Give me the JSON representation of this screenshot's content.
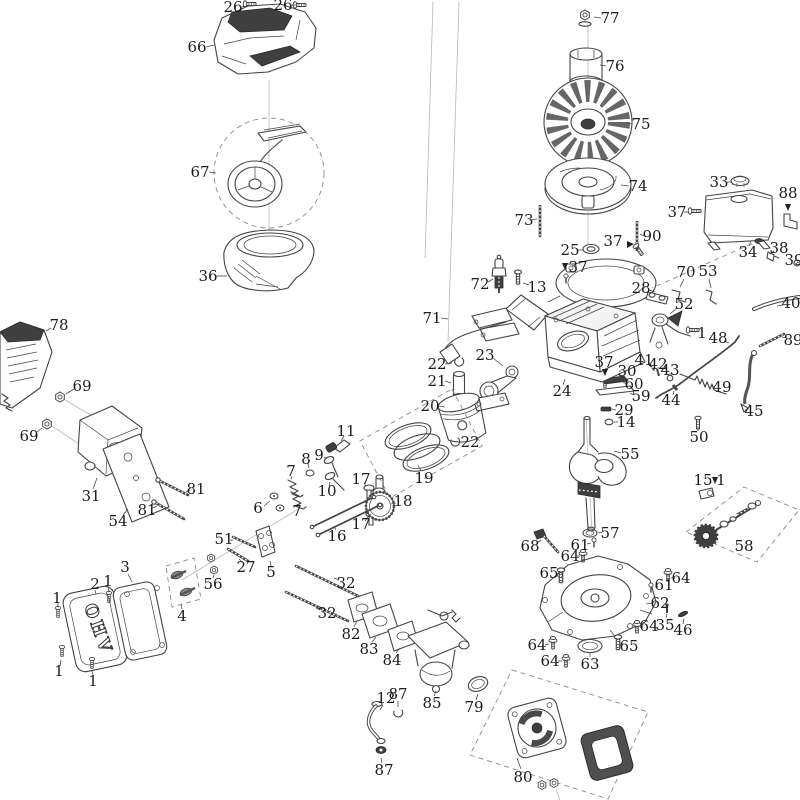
{
  "diagram": {
    "title": "engine-exploded-parts-diagram",
    "cover_text": "OHV",
    "colors": {
      "background": "#ffffff",
      "line": "#444444",
      "label": "#1c1c1c",
      "dark_fill": "#3f3f3f",
      "dash": "#8a8a8a"
    },
    "labels": [
      {
        "t": "26",
        "x": 233,
        "y": 7,
        "l": [
          241,
          7,
          247,
          6
        ]
      },
      {
        "t": "26",
        "x": 283,
        "y": 5,
        "l": [
          291,
          5,
          297,
          5
        ]
      },
      {
        "t": "66",
        "x": 197,
        "y": 47,
        "l": [
          206,
          47,
          214,
          45
        ]
      },
      {
        "t": "67",
        "x": 200,
        "y": 172,
        "l": [
          209,
          172,
          216,
          173
        ]
      },
      {
        "t": "36",
        "x": 208,
        "y": 276,
        "l": [
          216,
          276,
          227,
          276
        ]
      },
      {
        "t": "77",
        "x": 610,
        "y": 18,
        "l": [
          601,
          18,
          594,
          17
        ]
      },
      {
        "t": "76",
        "x": 615,
        "y": 66,
        "l": [
          606,
          66,
          600,
          65
        ]
      },
      {
        "t": "75",
        "x": 641,
        "y": 124,
        "l": [
          632,
          124,
          626,
          123
        ]
      },
      {
        "t": "74",
        "x": 638,
        "y": 186,
        "l": [
          629,
          186,
          621,
          185
        ]
      },
      {
        "t": "73",
        "x": 524,
        "y": 220,
        "l": [
          531,
          220,
          537,
          219
        ]
      },
      {
        "t": "25",
        "x": 570,
        "y": 250,
        "l": [
          578,
          250,
          584,
          250
        ]
      },
      {
        "t": "37",
        "x": 613,
        "y": 241
      },
      {
        "t": "37",
        "x": 578,
        "y": 267
      },
      {
        "t": "90",
        "x": 652,
        "y": 236,
        "l": [
          644,
          236,
          640,
          234
        ]
      },
      {
        "t": "33",
        "x": 719,
        "y": 182,
        "l": [
          727,
          182,
          732,
          182
        ]
      },
      {
        "t": "88",
        "x": 788,
        "y": 193
      },
      {
        "t": "37",
        "x": 677,
        "y": 212,
        "l": [
          684,
          212,
          688,
          212
        ]
      },
      {
        "t": "34",
        "x": 748,
        "y": 252,
        "l": [
          749,
          246,
          751,
          241
        ]
      },
      {
        "t": "38",
        "x": 779,
        "y": 248,
        "l": [
          774,
          251,
          770,
          254
        ]
      },
      {
        "t": "39",
        "x": 794,
        "y": 260,
        "l": [
          797,
          262,
          799,
          263
        ]
      },
      {
        "t": "40",
        "x": 791,
        "y": 303,
        "l": [
          783,
          305,
          777,
          306
        ]
      },
      {
        "t": "89",
        "x": 793,
        "y": 340,
        "l": [
          786,
          338,
          782,
          337
        ]
      },
      {
        "t": "28",
        "x": 641,
        "y": 288,
        "l": [
          649,
          290,
          655,
          292
        ]
      },
      {
        "t": "70",
        "x": 686,
        "y": 272,
        "l": [
          684,
          279,
          680,
          287
        ]
      },
      {
        "t": "53",
        "x": 708,
        "y": 271,
        "l": [
          709,
          279,
          711,
          288
        ]
      },
      {
        "t": "52",
        "x": 684,
        "y": 304,
        "l": [
          677,
          308,
          670,
          314
        ]
      },
      {
        "t": "1",
        "x": 702,
        "y": 333,
        "l": [
          696,
          332,
          692,
          331
        ]
      },
      {
        "t": "48",
        "x": 718,
        "y": 338,
        "l": [
          724,
          341,
          729,
          343
        ]
      },
      {
        "t": "41",
        "x": 644,
        "y": 360,
        "l": [
          648,
          363,
          650,
          366
        ]
      },
      {
        "t": "42",
        "x": 658,
        "y": 364,
        "l": [
          658,
          367,
          658,
          370
        ]
      },
      {
        "t": "43",
        "x": 670,
        "y": 370,
        "l": [
          670,
          373,
          670,
          376
        ]
      },
      {
        "t": "44",
        "x": 671,
        "y": 400,
        "l": [
          673,
          395,
          674,
          391
        ]
      },
      {
        "t": "49",
        "x": 722,
        "y": 387,
        "l": [
          715,
          387,
          712,
          387
        ]
      },
      {
        "t": "45",
        "x": 754,
        "y": 411,
        "l": [
          751,
          407,
          749,
          404
        ]
      },
      {
        "t": "50",
        "x": 699,
        "y": 437,
        "l": [
          698,
          431,
          698,
          428
        ]
      },
      {
        "t": "30",
        "x": 627,
        "y": 371,
        "l": [
          621,
          371,
          619,
          371
        ]
      },
      {
        "t": "60",
        "x": 634,
        "y": 384,
        "l": [
          627,
          384,
          623,
          382
        ]
      },
      {
        "t": "59",
        "x": 641,
        "y": 396,
        "l": [
          634,
          395,
          630,
          393
        ]
      },
      {
        "t": "29",
        "x": 624,
        "y": 410,
        "l": [
          616,
          410,
          612,
          409
        ]
      },
      {
        "t": "14",
        "x": 626,
        "y": 422,
        "l": [
          618,
          422,
          614,
          422
        ]
      },
      {
        "t": "37",
        "x": 604,
        "y": 362
      },
      {
        "t": "72",
        "x": 480,
        "y": 284,
        "l": [
          488,
          282,
          493,
          279
        ]
      },
      {
        "t": "13",
        "x": 537,
        "y": 287,
        "l": [
          529,
          285,
          523,
          283
        ]
      },
      {
        "t": "71",
        "x": 432,
        "y": 318,
        "l": [
          441,
          318,
          448,
          319
        ]
      },
      {
        "t": "24",
        "x": 562,
        "y": 391,
        "l": [
          563,
          385,
          565,
          379
        ]
      },
      {
        "t": "23",
        "x": 485,
        "y": 355,
        "l": [
          493,
          358,
          503,
          366
        ]
      },
      {
        "t": "22",
        "x": 437,
        "y": 364,
        "l": [
          445,
          364,
          452,
          363
        ]
      },
      {
        "t": "21",
        "x": 437,
        "y": 381,
        "l": [
          445,
          381,
          451,
          383
        ]
      },
      {
        "t": "20",
        "x": 430,
        "y": 406,
        "l": [
          438,
          406,
          445,
          407
        ]
      },
      {
        "t": "19",
        "x": 424,
        "y": 478,
        "l": [
          421,
          471,
          418,
          465
        ]
      },
      {
        "t": "22",
        "x": 470,
        "y": 442,
        "l": [
          462,
          442,
          458,
          442
        ]
      },
      {
        "t": "11",
        "x": 346,
        "y": 431,
        "l": [
          344,
          436,
          341,
          441
        ]
      },
      {
        "t": "9",
        "x": 319,
        "y": 455,
        "l": [
          324,
          457,
          327,
          459
        ]
      },
      {
        "t": "8",
        "x": 306,
        "y": 459,
        "l": [
          308,
          464,
          309,
          468
        ]
      },
      {
        "t": "7",
        "x": 291,
        "y": 471,
        "l": [
          292,
          476,
          291,
          479
        ]
      },
      {
        "t": "7",
        "x": 297,
        "y": 511,
        "l": [
          298,
          506,
          300,
          503
        ]
      },
      {
        "t": "6",
        "x": 258,
        "y": 508,
        "l": [
          264,
          506,
          270,
          501
        ]
      },
      {
        "t": "10",
        "x": 327,
        "y": 491,
        "l": [
          329,
          486,
          330,
          482
        ]
      },
      {
        "t": "17",
        "x": 361,
        "y": 479,
        "l": [
          364,
          483,
          366,
          486
        ]
      },
      {
        "t": "17",
        "x": 361,
        "y": 524,
        "l": [
          365,
          521,
          368,
          517
        ]
      },
      {
        "t": "18",
        "x": 403,
        "y": 501,
        "l": [
          396,
          503,
          391,
          504
        ]
      },
      {
        "t": "16",
        "x": 337,
        "y": 536,
        "l": [
          336,
          530,
          334,
          526
        ]
      },
      {
        "t": "78",
        "x": 59,
        "y": 325,
        "l": [
          51,
          328,
          46,
          331
        ]
      },
      {
        "t": "69",
        "x": 82,
        "y": 386,
        "l": [
          74,
          389,
          66,
          394
        ]
      },
      {
        "t": "69",
        "x": 29,
        "y": 436,
        "l": [
          37,
          432,
          42,
          428
        ]
      },
      {
        "t": "31",
        "x": 91,
        "y": 496,
        "l": [
          93,
          489,
          97,
          478
        ]
      },
      {
        "t": "54",
        "x": 118,
        "y": 521,
        "l": [
          123,
          515,
          128,
          509
        ]
      },
      {
        "t": "81",
        "x": 196,
        "y": 489,
        "l": [
          190,
          490,
          186,
          492
        ]
      },
      {
        "t": "81",
        "x": 147,
        "y": 510,
        "l": [
          153,
          508,
          157,
          506
        ]
      },
      {
        "t": "1",
        "x": 57,
        "y": 598,
        "l": [
          58,
          603,
          58,
          607
        ]
      },
      {
        "t": "2",
        "x": 95,
        "y": 584,
        "l": [
          95,
          590,
          96,
          594
        ]
      },
      {
        "t": "1",
        "x": 108,
        "y": 581,
        "l": [
          108,
          587,
          109,
          591
        ]
      },
      {
        "t": "3",
        "x": 125,
        "y": 567,
        "l": [
          128,
          574,
          132,
          582
        ]
      },
      {
        "t": "4",
        "x": 182,
        "y": 616,
        "l": [
          182,
          609,
          181,
          604
        ]
      },
      {
        "t": "1",
        "x": 59,
        "y": 671,
        "l": [
          60,
          666,
          61,
          660
        ]
      },
      {
        "t": "1",
        "x": 93,
        "y": 681,
        "l": [
          93,
          675,
          92,
          671
        ]
      },
      {
        "t": "51",
        "x": 224,
        "y": 539,
        "l": [
          230,
          540,
          233,
          540
        ]
      },
      {
        "t": "27",
        "x": 246,
        "y": 567,
        "l": [
          242,
          562,
          239,
          559
        ]
      },
      {
        "t": "56",
        "x": 213,
        "y": 584,
        "l": [
          213,
          578,
          214,
          575
        ]
      },
      {
        "t": "5",
        "x": 271,
        "y": 572,
        "l": [
          271,
          566,
          270,
          561
        ]
      },
      {
        "t": "32",
        "x": 346,
        "y": 583,
        "l": [
          339,
          580,
          334,
          578
        ]
      },
      {
        "t": "32",
        "x": 327,
        "y": 613,
        "l": [
          320,
          610,
          316,
          608
        ]
      },
      {
        "t": "82",
        "x": 351,
        "y": 634,
        "l": [
          354,
          627,
          357,
          621
        ]
      },
      {
        "t": "83",
        "x": 369,
        "y": 649,
        "l": [
          372,
          642,
          376,
          637
        ]
      },
      {
        "t": "84",
        "x": 392,
        "y": 660,
        "l": [
          396,
          653,
          400,
          648
        ]
      },
      {
        "t": "85",
        "x": 432,
        "y": 703,
        "l": [
          434,
          696,
          436,
          691
        ]
      },
      {
        "t": "12",
        "x": 386,
        "y": 698,
        "l": [
          383,
          705,
          380,
          710
        ]
      },
      {
        "t": "87",
        "x": 398,
        "y": 694,
        "l": [
          398,
          701,
          398,
          707
        ]
      },
      {
        "t": "87",
        "x": 384,
        "y": 770,
        "l": [
          382,
          763,
          381,
          758
        ]
      },
      {
        "t": "79",
        "x": 474,
        "y": 707,
        "l": [
          476,
          700,
          478,
          694
        ]
      },
      {
        "t": "55",
        "x": 630,
        "y": 454,
        "l": [
          621,
          453,
          614,
          451
        ]
      },
      {
        "t": "57",
        "x": 610,
        "y": 533,
        "l": [
          602,
          533,
          598,
          532
        ]
      },
      {
        "t": "68",
        "x": 530,
        "y": 546,
        "l": [
          537,
          543,
          541,
          540
        ]
      },
      {
        "t": "61",
        "x": 580,
        "y": 545,
        "l": [
          587,
          544,
          591,
          543
        ]
      },
      {
        "t": "64",
        "x": 570,
        "y": 556,
        "l": [
          577,
          556,
          580,
          556
        ]
      },
      {
        "t": "65",
        "x": 549,
        "y": 573,
        "l": [
          556,
          573,
          558,
          574
        ]
      },
      {
        "t": "64",
        "x": 681,
        "y": 578,
        "l": [
          675,
          578,
          671,
          578
        ]
      },
      {
        "t": "61",
        "x": 664,
        "y": 585,
        "l": [
          658,
          586,
          655,
          587
        ]
      },
      {
        "t": "62",
        "x": 660,
        "y": 603,
        "l": [
          652,
          603,
          646,
          604
        ]
      },
      {
        "t": "64",
        "x": 649,
        "y": 626,
        "l": [
          643,
          627,
          640,
          627
        ]
      },
      {
        "t": "35",
        "x": 665,
        "y": 625,
        "l": [
          666,
          618,
          667,
          614
        ]
      },
      {
        "t": "46",
        "x": 683,
        "y": 630,
        "l": [
          683,
          624,
          684,
          619
        ]
      },
      {
        "t": "65",
        "x": 629,
        "y": 646,
        "l": [
          623,
          644,
          621,
          643
        ]
      },
      {
        "t": "64",
        "x": 537,
        "y": 645,
        "l": [
          545,
          645,
          549,
          644
        ]
      },
      {
        "t": "64",
        "x": 550,
        "y": 661,
        "l": [
          558,
          661,
          562,
          661
        ]
      },
      {
        "t": "63",
        "x": 590,
        "y": 664,
        "l": [
          590,
          657,
          590,
          653
        ]
      },
      {
        "t": "15",
        "x": 703,
        "y": 480
      },
      {
        "t": "1",
        "x": 721,
        "y": 480
      },
      {
        "t": "58",
        "x": 744,
        "y": 546
      },
      {
        "t": "80",
        "x": 523,
        "y": 777,
        "l": [
          521,
          769,
          517,
          758
        ]
      }
    ],
    "arrows": [
      [
        627,
        241,
        634,
        244,
        627,
        248
      ],
      [
        562,
        263,
        568,
        263,
        565,
        270
      ],
      [
        602,
        369,
        608,
        369,
        605,
        376
      ],
      [
        712,
        477,
        718,
        477,
        715,
        484
      ],
      [
        785,
        204,
        791,
        204,
        788,
        211
      ]
    ]
  }
}
